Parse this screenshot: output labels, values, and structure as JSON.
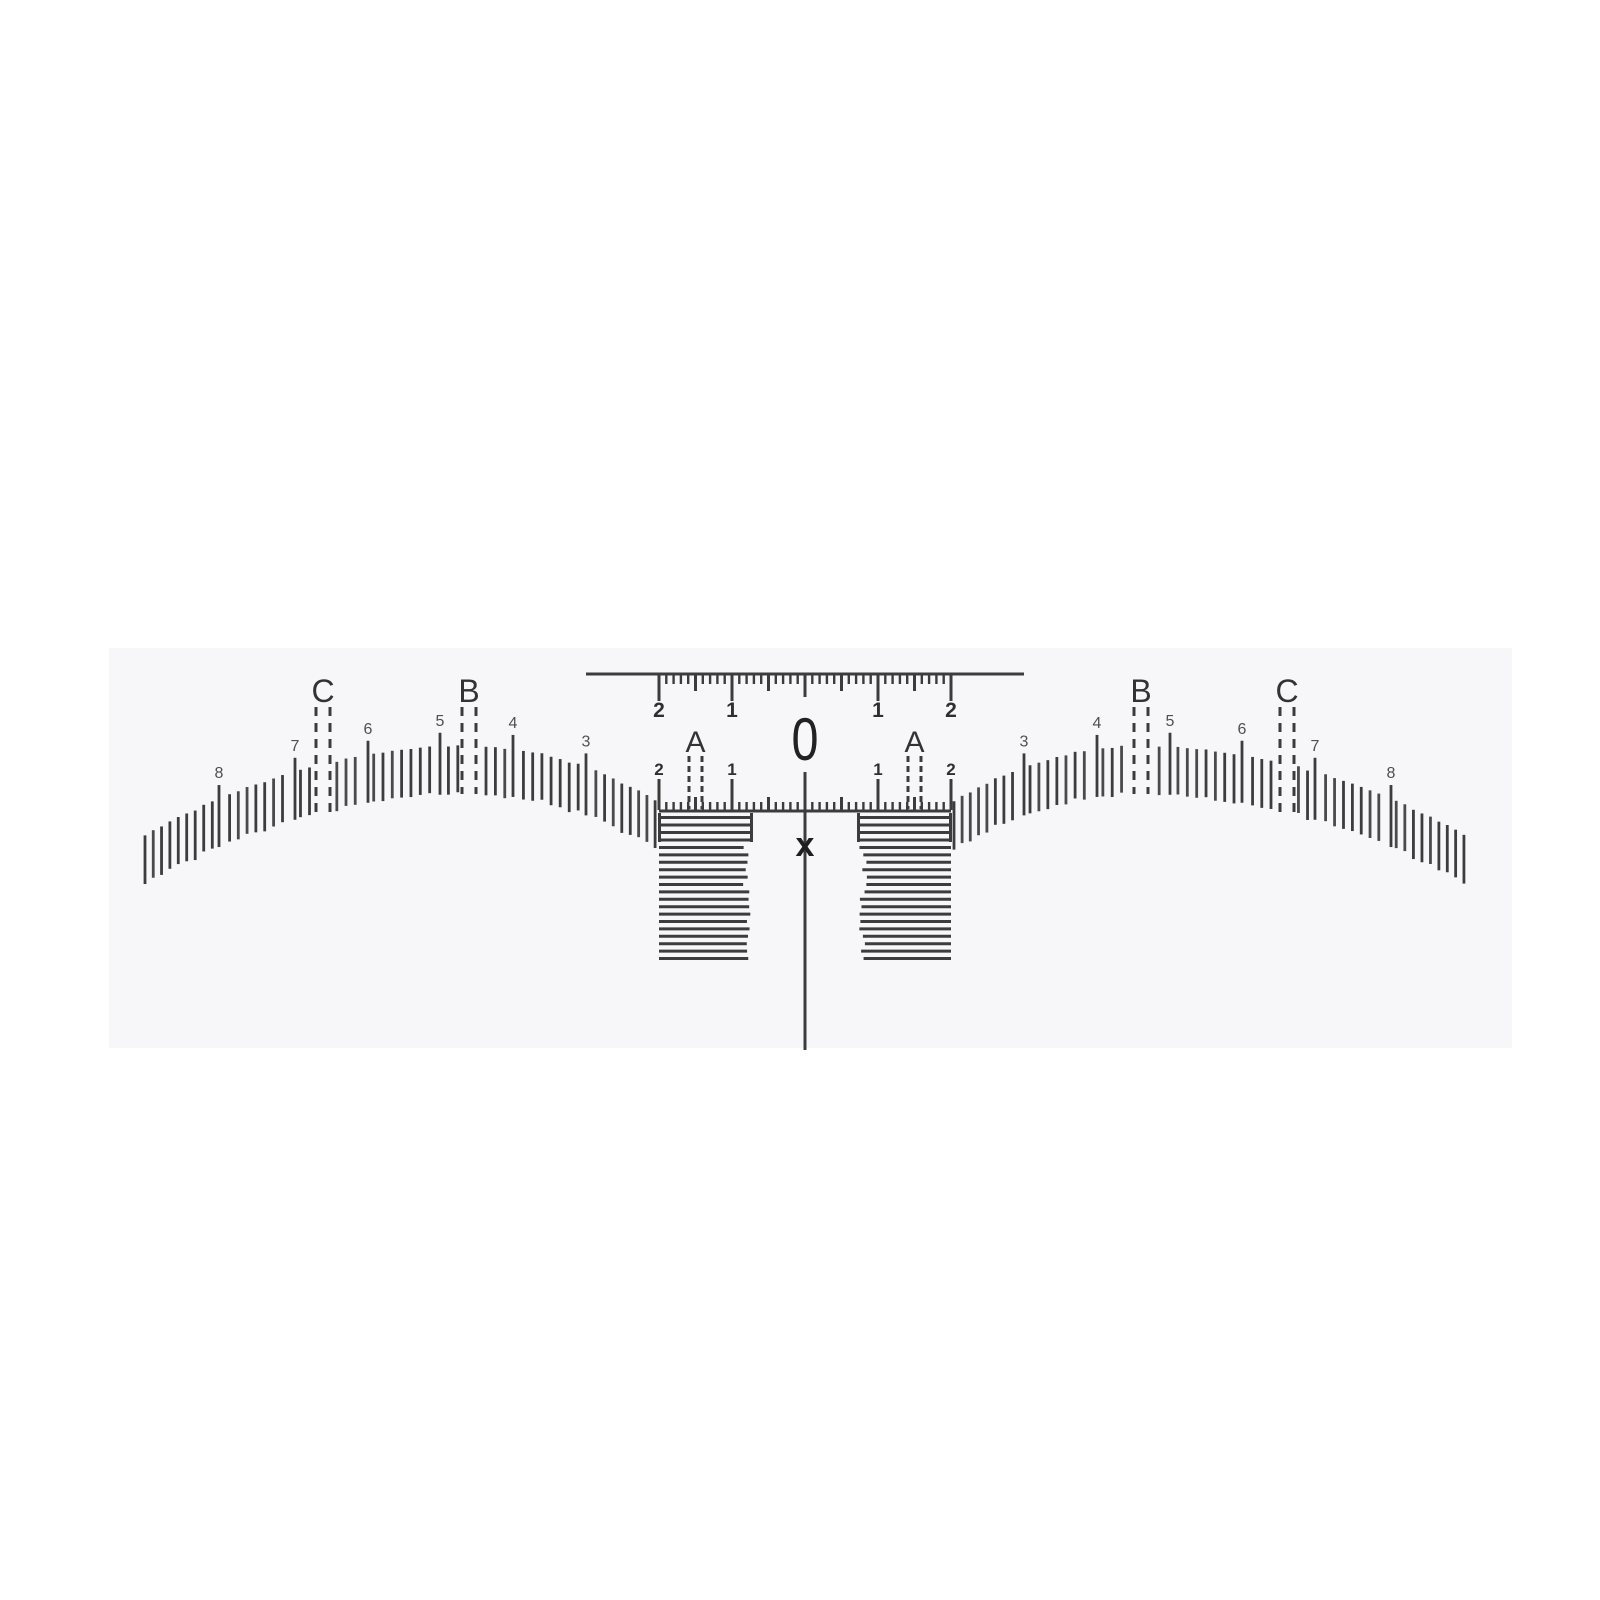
{
  "image": {
    "kind": "product-photo of a disposable eyebrow mapping ruler sticker",
    "background_color": "#ffffff"
  },
  "sticker": {
    "fill": "#f7f7fa",
    "ink": "#3c3c3c",
    "x": 109,
    "y": 648,
    "width": 1403,
    "height": 400
  },
  "diagram": {
    "center_x": 805,
    "unit_px": 73,
    "top_ruler": {
      "line_y": 674,
      "x_start": 586,
      "x_end": 1024,
      "stroke_w": 3,
      "tick_step_px": 7.3,
      "minor_len": 9,
      "medium_len": 16,
      "major_len": 26,
      "zero_len": 22,
      "labels": [
        {
          "text": "2",
          "unit": -2
        },
        {
          "text": "1",
          "unit": -1
        },
        {
          "text": "1",
          "unit": 1
        },
        {
          "text": "2",
          "unit": 2
        }
      ],
      "label_baseline_y": 717,
      "label_font_px": 21
    },
    "zero_mark": {
      "text": "0",
      "x": 805,
      "baseline_y": 760,
      "font_px": 60,
      "text_length": 27
    },
    "mid_ruler": {
      "line_y": 811,
      "stroke_w": 3,
      "unit_start": -2,
      "unit_end": 2,
      "tick_step_px": 7.3,
      "minor_len": 8,
      "medium_len": 13,
      "major_len": 31,
      "labels": [
        {
          "text": "2",
          "unit": -2
        },
        {
          "text": "1",
          "unit": -1
        },
        {
          "text": "1",
          "unit": 1
        },
        {
          "text": "2",
          "unit": 2
        }
      ],
      "label_baseline_y": 775,
      "label_font_px": 17
    },
    "a_guides": {
      "letter": "A",
      "letter_font_px": 30,
      "letter_baseline_y": 752,
      "centers_unit": [
        -1.5,
        1.5
      ],
      "pair_half_gap": 6.5,
      "top_y": 756,
      "bottom_y": 809,
      "dash": "6 4",
      "stroke_w": 3
    },
    "center_axis": {
      "x": 805,
      "top_y": 772,
      "bottom_y": 1050,
      "stroke_w": 3,
      "x_label": "x",
      "x_label_baseline_y": 856,
      "x_label_font_px": 34
    },
    "hatch_blocks": {
      "stroke_w": 3,
      "boxed_rows_y": [
        817.5,
        825,
        832.5,
        840
      ],
      "cap_top_y": 813,
      "cap_bottom_y": 842,
      "free_row_start_y": 847.5,
      "free_row_step": 7.4,
      "free_row_count": 16,
      "left": {
        "x1": 658,
        "x2": 753,
        "ragged_side": "right"
      },
      "right": {
        "x1": 857,
        "x2": 952,
        "ragged_side": "left"
      }
    },
    "arches": {
      "tick_len": 48,
      "stroke_w": 3,
      "arc_spacing": 9.4,
      "int_tick_rise": 14,
      "number_font_px": 16,
      "number_color": "#4f4f4f",
      "number_baseline_rise": 21,
      "letter_font_px": 32,
      "letter_color": "#333333",
      "letter_baseline_y": 702,
      "guide_dash": "9 7",
      "guide_half_gap": 7,
      "guide_top_y": 707,
      "left": {
        "x_start": 145,
        "x_end": 656,
        "apex_x": 470,
        "apex_top_y": 746,
        "k_outer": 0.000842,
        "k_inner": 0.00159,
        "outer_side": "left",
        "numbers": [
          {
            "text": "8",
            "x": 219
          },
          {
            "text": "7",
            "x": 295
          },
          {
            "text": "6",
            "x": 368
          },
          {
            "text": "5",
            "x": 440
          },
          {
            "text": "4",
            "x": 513
          },
          {
            "text": "3",
            "x": 586
          }
        ],
        "letter_guides": [
          {
            "text": "C",
            "x": 323
          },
          {
            "text": "B",
            "x": 469
          }
        ]
      },
      "right": {
        "x_start": 954,
        "x_end": 1465,
        "apex_x": 1140,
        "apex_top_y": 746,
        "k_outer": 0.000842,
        "k_inner": 0.00159,
        "outer_side": "right",
        "numbers": [
          {
            "text": "3",
            "x": 1024
          },
          {
            "text": "4",
            "x": 1097
          },
          {
            "text": "5",
            "x": 1170
          },
          {
            "text": "6",
            "x": 1242
          },
          {
            "text": "7",
            "x": 1315
          },
          {
            "text": "8",
            "x": 1391
          }
        ],
        "letter_guides": [
          {
            "text": "B",
            "x": 1141
          },
          {
            "text": "C",
            "x": 1287
          }
        ]
      }
    }
  }
}
